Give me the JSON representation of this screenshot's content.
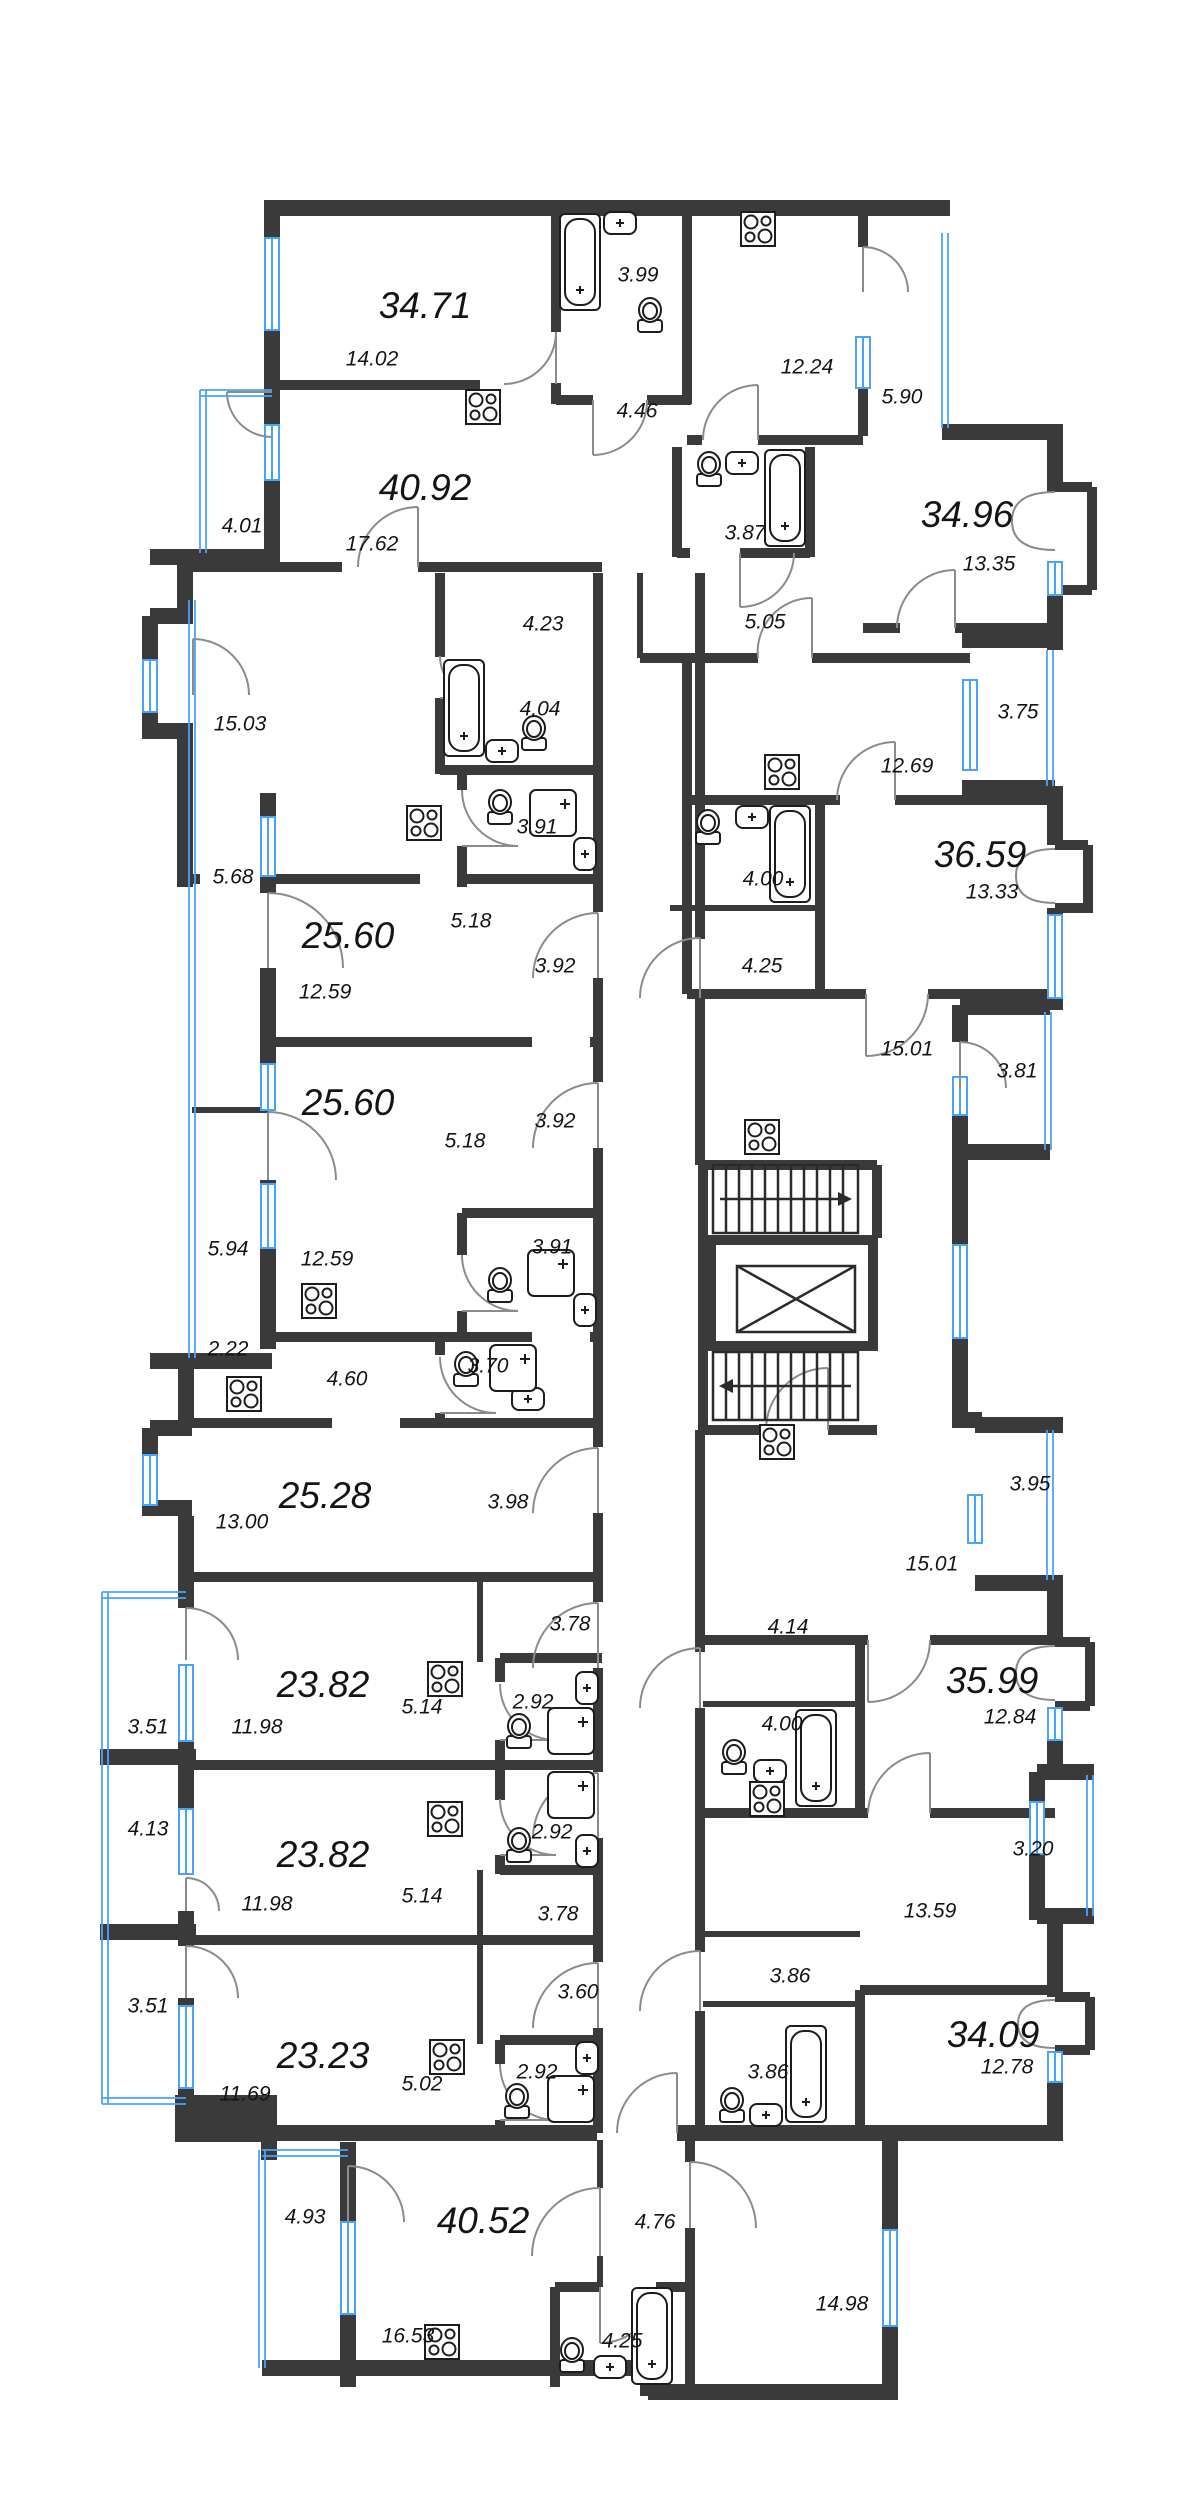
{
  "plan": {
    "colors": {
      "wall": "#3a3a3a",
      "window": "#4aa2ff",
      "background": "#ffffff",
      "door_arc": "#8b8b8b",
      "text": "#141414"
    },
    "icons": [
      "stove-icon",
      "bathtub-icon",
      "toilet-icon",
      "sink-icon",
      "shower-icon",
      "stairs-icon",
      "elevator-icon"
    ],
    "apartments": [
      {
        "total": "34.71",
        "rooms": [
          "14.02",
          "12.24",
          "3.99",
          "4.46"
        ]
      },
      {
        "total": "40.92",
        "rooms": [
          "17.62",
          "15.03",
          "4.23",
          "4.04"
        ]
      },
      {
        "total": "34.96",
        "rooms": [
          "13.35",
          "12.69",
          "5.05",
          "3.87"
        ]
      },
      {
        "total": "36.59",
        "rooms": [
          "13.33",
          "15.01",
          "4.00",
          "4.25"
        ]
      },
      {
        "total": "25.60",
        "rooms": [
          "12.59",
          "5.18",
          "3.92",
          "3.91"
        ]
      },
      {
        "total": "25.60",
        "rooms": [
          "12.59",
          "5.18",
          "3.92",
          "3.91"
        ]
      },
      {
        "total": "25.28",
        "rooms": [
          "13.00",
          "4.60",
          "3.70",
          "3.98"
        ]
      },
      {
        "total": "23.82",
        "rooms": [
          "11.98",
          "5.14",
          "2.92",
          "3.78"
        ]
      },
      {
        "total": "23.82",
        "rooms": [
          "11.98",
          "5.14",
          "2.92",
          "3.78"
        ]
      },
      {
        "total": "35.99",
        "rooms": [
          "12.84",
          "15.01",
          "4.00",
          "4.14"
        ]
      },
      {
        "total": "23.23",
        "rooms": [
          "11.69",
          "5.02",
          "2.92",
          "3.60"
        ]
      },
      {
        "total": "34.09",
        "rooms": [
          "12.78",
          "13.59",
          "3.86",
          "3.86"
        ]
      },
      {
        "total": "40.52",
        "rooms": [
          "16.53",
          "14.98",
          "4.25",
          "4.76"
        ]
      }
    ],
    "balconies": [
      "5.90",
      "4.01",
      "3.75",
      "5.68",
      "3.81",
      "5.94",
      "2.22",
      "3.95",
      "3.51",
      "4.13",
      "3.20",
      "3.51",
      "4.93"
    ],
    "labels": [
      {
        "t": "34.71",
        "x": 425,
        "y": 308,
        "k": "apt"
      },
      {
        "t": "40.92",
        "x": 425,
        "y": 490,
        "k": "apt"
      },
      {
        "t": "25.60",
        "x": 348,
        "y": 938,
        "k": "apt"
      },
      {
        "t": "25.60",
        "x": 348,
        "y": 1105,
        "k": "apt"
      },
      {
        "t": "25.28",
        "x": 325,
        "y": 1498,
        "k": "apt"
      },
      {
        "t": "23.82",
        "x": 323,
        "y": 1687,
        "k": "apt"
      },
      {
        "t": "23.82",
        "x": 323,
        "y": 1857,
        "k": "apt"
      },
      {
        "t": "23.23",
        "x": 323,
        "y": 2058,
        "k": "apt"
      },
      {
        "t": "40.52",
        "x": 483,
        "y": 2223,
        "k": "apt"
      },
      {
        "t": "34.96",
        "x": 967,
        "y": 517,
        "k": "apt"
      },
      {
        "t": "36.59",
        "x": 980,
        "y": 857,
        "k": "apt"
      },
      {
        "t": "35.99",
        "x": 992,
        "y": 1683,
        "k": "apt"
      },
      {
        "t": "34.09",
        "x": 993,
        "y": 2037,
        "k": "apt"
      },
      {
        "t": "14.02",
        "x": 372,
        "y": 360,
        "k": "room"
      },
      {
        "t": "3.99",
        "x": 638,
        "y": 276,
        "k": "room"
      },
      {
        "t": "12.24",
        "x": 807,
        "y": 368,
        "k": "room"
      },
      {
        "t": "5.90",
        "x": 902,
        "y": 398,
        "k": "room"
      },
      {
        "t": "4.46",
        "x": 637,
        "y": 412,
        "k": "room"
      },
      {
        "t": "4.01",
        "x": 242,
        "y": 527,
        "k": "room"
      },
      {
        "t": "17.62",
        "x": 372,
        "y": 545,
        "k": "room"
      },
      {
        "t": "3.87",
        "x": 745,
        "y": 534,
        "k": "room"
      },
      {
        "t": "13.35",
        "x": 989,
        "y": 565,
        "k": "room"
      },
      {
        "t": "4.23",
        "x": 543,
        "y": 625,
        "k": "room"
      },
      {
        "t": "5.05",
        "x": 765,
        "y": 623,
        "k": "room"
      },
      {
        "t": "4.04",
        "x": 540,
        "y": 710,
        "k": "room"
      },
      {
        "t": "15.03",
        "x": 240,
        "y": 725,
        "k": "room"
      },
      {
        "t": "3.75",
        "x": 1018,
        "y": 713,
        "k": "room"
      },
      {
        "t": "12.69",
        "x": 907,
        "y": 767,
        "k": "room"
      },
      {
        "t": "3.91",
        "x": 537,
        "y": 828,
        "k": "room"
      },
      {
        "t": "5.68",
        "x": 233,
        "y": 878,
        "k": "room"
      },
      {
        "t": "4.00",
        "x": 763,
        "y": 880,
        "k": "room"
      },
      {
        "t": "13.33",
        "x": 992,
        "y": 893,
        "k": "room"
      },
      {
        "t": "5.18",
        "x": 471,
        "y": 922,
        "k": "room"
      },
      {
        "t": "3.92",
        "x": 555,
        "y": 967,
        "k": "room"
      },
      {
        "t": "4.25",
        "x": 762,
        "y": 967,
        "k": "room"
      },
      {
        "t": "12.59",
        "x": 325,
        "y": 993,
        "k": "room"
      },
      {
        "t": "15.01",
        "x": 907,
        "y": 1050,
        "k": "room"
      },
      {
        "t": "3.81",
        "x": 1017,
        "y": 1072,
        "k": "room"
      },
      {
        "t": "3.92",
        "x": 555,
        "y": 1122,
        "k": "room"
      },
      {
        "t": "5.18",
        "x": 465,
        "y": 1142,
        "k": "room"
      },
      {
        "t": "3.91",
        "x": 552,
        "y": 1248,
        "k": "room"
      },
      {
        "t": "5.94",
        "x": 228,
        "y": 1250,
        "k": "room"
      },
      {
        "t": "12.59",
        "x": 327,
        "y": 1260,
        "k": "room"
      },
      {
        "t": "2.22",
        "x": 228,
        "y": 1350,
        "k": "room"
      },
      {
        "t": "3.70",
        "x": 488,
        "y": 1367,
        "k": "room"
      },
      {
        "t": "4.60",
        "x": 347,
        "y": 1380,
        "k": "room"
      },
      {
        "t": "3.95",
        "x": 1030,
        "y": 1485,
        "k": "room"
      },
      {
        "t": "3.98",
        "x": 508,
        "y": 1503,
        "k": "room"
      },
      {
        "t": "13.00",
        "x": 242,
        "y": 1523,
        "k": "room"
      },
      {
        "t": "15.01",
        "x": 932,
        "y": 1565,
        "k": "room"
      },
      {
        "t": "3.78",
        "x": 570,
        "y": 1625,
        "k": "room"
      },
      {
        "t": "4.14",
        "x": 788,
        "y": 1628,
        "k": "room"
      },
      {
        "t": "2.92",
        "x": 533,
        "y": 1703,
        "k": "room"
      },
      {
        "t": "5.14",
        "x": 422,
        "y": 1708,
        "k": "room"
      },
      {
        "t": "12.84",
        "x": 1010,
        "y": 1718,
        "k": "room"
      },
      {
        "t": "4.00",
        "x": 782,
        "y": 1725,
        "k": "room"
      },
      {
        "t": "11.98",
        "x": 257,
        "y": 1728,
        "k": "room"
      },
      {
        "t": "3.51",
        "x": 148,
        "y": 1728,
        "k": "room"
      },
      {
        "t": "4.13",
        "x": 148,
        "y": 1830,
        "k": "room"
      },
      {
        "t": "2.92",
        "x": 552,
        "y": 1833,
        "k": "room"
      },
      {
        "t": "3.20",
        "x": 1033,
        "y": 1850,
        "k": "room"
      },
      {
        "t": "5.14",
        "x": 422,
        "y": 1897,
        "k": "room"
      },
      {
        "t": "11.98",
        "x": 267,
        "y": 1905,
        "k": "room"
      },
      {
        "t": "3.78",
        "x": 558,
        "y": 1915,
        "k": "room"
      },
      {
        "t": "13.59",
        "x": 930,
        "y": 1912,
        "k": "room"
      },
      {
        "t": "3.60",
        "x": 578,
        "y": 1993,
        "k": "room"
      },
      {
        "t": "3.86",
        "x": 790,
        "y": 1977,
        "k": "room"
      },
      {
        "t": "3.51",
        "x": 148,
        "y": 2007,
        "k": "room"
      },
      {
        "t": "12.78",
        "x": 1007,
        "y": 2068,
        "k": "room"
      },
      {
        "t": "2.92",
        "x": 537,
        "y": 2073,
        "k": "room"
      },
      {
        "t": "3.86",
        "x": 768,
        "y": 2073,
        "k": "room"
      },
      {
        "t": "5.02",
        "x": 422,
        "y": 2085,
        "k": "room"
      },
      {
        "t": "11.69",
        "x": 245,
        "y": 2095,
        "k": "room"
      },
      {
        "t": "4.93",
        "x": 305,
        "y": 2218,
        "k": "room"
      },
      {
        "t": "4.76",
        "x": 655,
        "y": 2223,
        "k": "room"
      },
      {
        "t": "14.98",
        "x": 842,
        "y": 2305,
        "k": "room"
      },
      {
        "t": "16.53",
        "x": 408,
        "y": 2337,
        "k": "room"
      },
      {
        "t": "4.25",
        "x": 622,
        "y": 2342,
        "k": "room"
      }
    ]
  }
}
